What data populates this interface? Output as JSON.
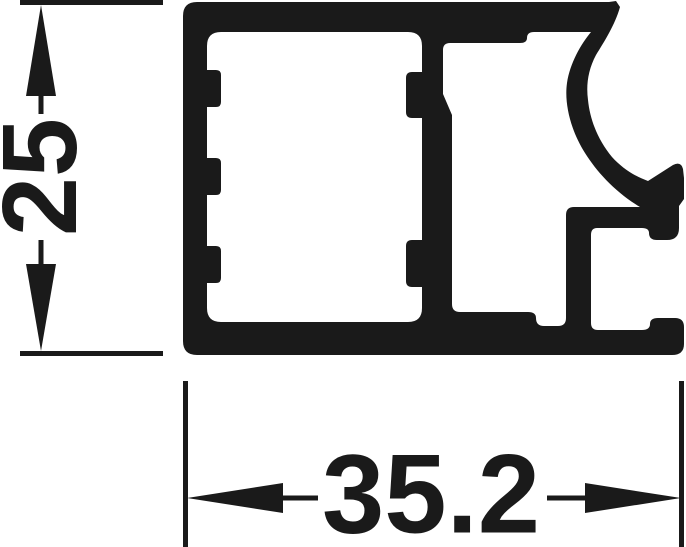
{
  "drawing": {
    "title": "Aluminium profile cross-section technical drawing",
    "colors": {
      "ink": "#1a1a1a",
      "background": "#ffffff"
    },
    "dimensions": {
      "height": {
        "value": "25",
        "orientation": "vertical"
      },
      "width": {
        "value": "35.2",
        "orientation": "horizontal"
      }
    }
  }
}
